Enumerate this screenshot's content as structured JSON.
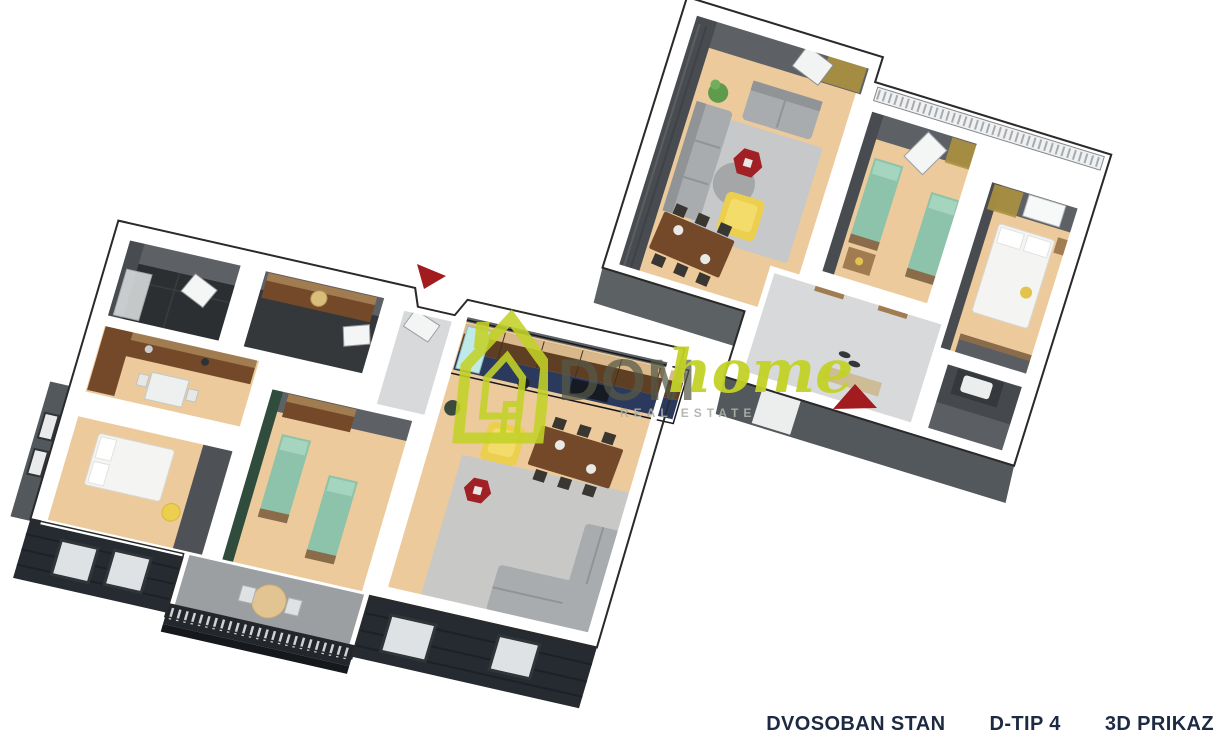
{
  "canvas": {
    "width": 1224,
    "height": 745,
    "background": "#ffffff"
  },
  "caption": {
    "items": [
      "DVOSOBAN STAN",
      "D-TIP 4",
      "3D PRIKAZ"
    ]
  },
  "watermark": {
    "brand_prefix": "DOM",
    "brand_suffix": "home",
    "tagline": "REAL ESTATE"
  },
  "plans": [
    {
      "id": "apartment-3d-view-a",
      "position": "lower-left",
      "rooms": [
        "living-room-with-kitchen",
        "kids-room",
        "bedroom",
        "kitchen",
        "bathroom",
        "entry-hall",
        "balcony"
      ]
    },
    {
      "id": "apartment-3d-view-b",
      "position": "upper-right",
      "rooms": [
        "living-room",
        "kids-room",
        "bedroom",
        "hallway",
        "bathroom",
        "terrace-edge"
      ]
    }
  ],
  "colors": {
    "background": "#ffffff",
    "wall_face": "#5d6165",
    "wall_face_dark": "#484c50",
    "wall_cap": "#ffffff",
    "outline": "#2a2a2a",
    "facade_gray": "#53585c",
    "facade_dark": "#262a31",
    "railing_dark": "#23262b",
    "floor_wood": "#ecca9b",
    "floor_tile_light": "#d7d9da",
    "floor_tile_dark": "#45484c",
    "floor_tile_black": "#2c2f31",
    "rug": "#c6c8c9",
    "sofa": "#a8acae",
    "sofa_dark": "#909497",
    "bed_green": "#8cc3aa",
    "bed_white": "#f4f4f2",
    "armchair_yellow": "#eccf4f",
    "table_red": "#a02025",
    "wood_furniture": "#74492a",
    "wood_light": "#a07c50",
    "counter_navy": "#2b3a5c",
    "fridge_teal": "#c0e9ea",
    "curtain_gold": "#ac923f",
    "plant_green": "#5e9b4d",
    "chair_dark": "#3a3632",
    "accent_wall_green": "#2f4c3d",
    "balcony_floor": "#9b9fa2",
    "brand_lime": "#c3d227",
    "brand_gray": "#565947",
    "tagline_gray": "#aeb1a9",
    "caption_navy": "#1e2a44",
    "marker_red": "#a21b1e"
  }
}
